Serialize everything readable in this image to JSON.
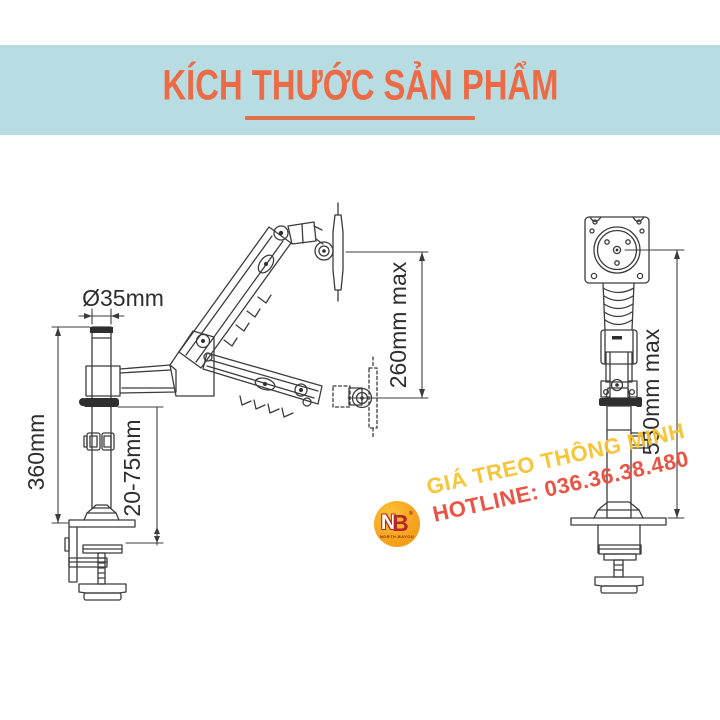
{
  "header": {
    "title": "KÍCH THƯỚC SẢN PHẨM",
    "band_color": "#b7dce1",
    "accent_color": "#ec6a45"
  },
  "dimensions": {
    "pole_diameter": "Ø35mm",
    "pole_height": "360mm",
    "clamp_range": "20-75mm",
    "vertical_travel": "260mm max",
    "column_height": "550mm max"
  },
  "watermark": {
    "logo_n": "N",
    "logo_b": "B",
    "logo_registered": "®",
    "logo_subtext": "NORTH-BAYOU",
    "line1": "GIÁ TREO THÔNG MINH",
    "line2": "HOTLINE: 036.36.38.480",
    "line1_color": "#f6c22e",
    "line2_color": "#e94b3c"
  }
}
